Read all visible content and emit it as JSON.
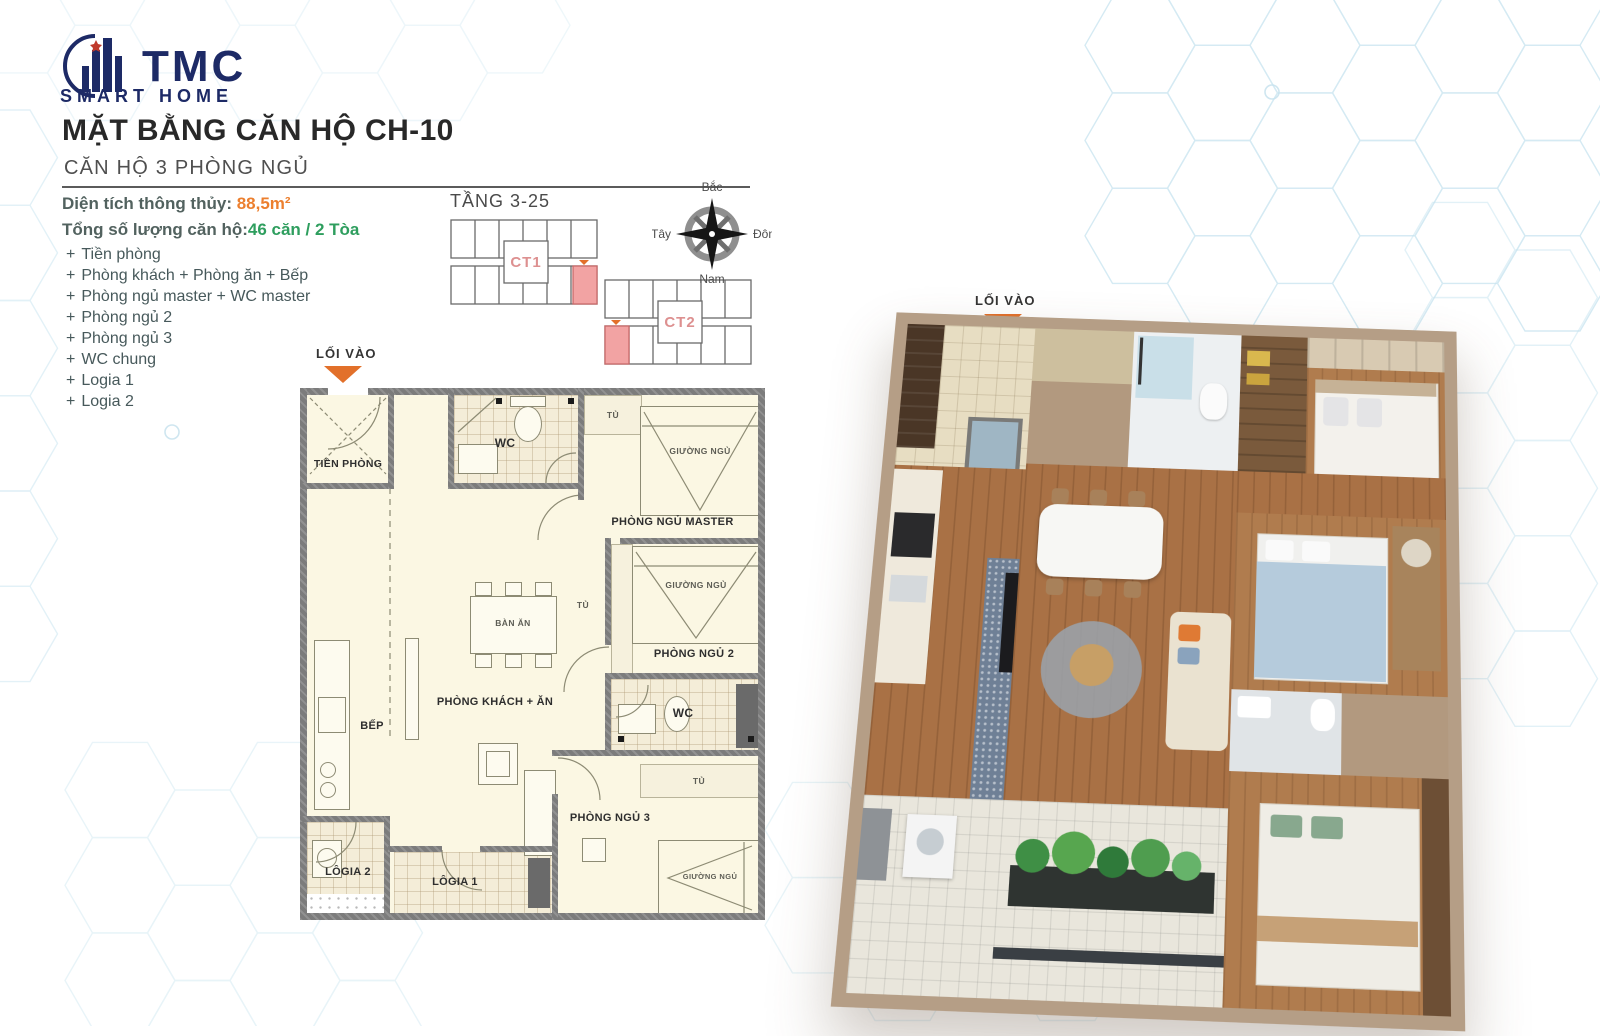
{
  "logo": {
    "name": "TMC",
    "tagline": "SMART HOME"
  },
  "header": {
    "title": "MẶT BẰNG CĂN HỘ CH-10",
    "subtitle": "CĂN HỘ 3 PHÒNG NGỦ"
  },
  "info": {
    "area_label": "Diện tích thông thủy:",
    "area_value": "88,5m²",
    "total_label": "Tổng số lượng căn hộ:",
    "total_value": "46 căn / 2 Tòa",
    "rooms": [
      "Tiền phòng",
      "Phòng khách + Phòng ăn + Bếp",
      "Phòng ngủ master + WC master",
      "Phòng ngủ 2",
      "Phòng ngủ 3",
      "WC chung",
      "Logia 1",
      "Logia 2"
    ]
  },
  "location": {
    "floor_label": "TẦNG 3-25",
    "towers": [
      {
        "label": "CT1"
      },
      {
        "label": "CT2"
      }
    ]
  },
  "compass": {
    "north": "Bắc",
    "east": "Đông",
    "south": "Nam",
    "west": "Tây"
  },
  "plan2d": {
    "entrance_label": "LỐI VÀO",
    "tien_phong": "TIỀN PHÒNG",
    "wc_label": "WC",
    "phong_ngu_master": "PHÒNG NGỦ MASTER",
    "bed_label": "GIƯỜNG NGỦ",
    "wardrobe_label": "TỦ",
    "ban_an": "BÀN ĂN",
    "phong_ngu_2": "PHÒNG NGỦ 2",
    "phong_khach": "PHÒNG KHÁCH + ĂN",
    "bep": "BẾP",
    "phong_ngu_3": "PHÒNG NGỦ 3",
    "logia_1": "LÔGIA 1",
    "logia_2": "LÔGIA 2"
  },
  "plan3d": {
    "entrance_label": "LỐI VÀO"
  },
  "colors": {
    "accent_orange": "#e2702a",
    "accent_green": "#2e9e5e",
    "highlight_pink": "#f2a3a3",
    "brand_navy": "#1d2a66"
  }
}
